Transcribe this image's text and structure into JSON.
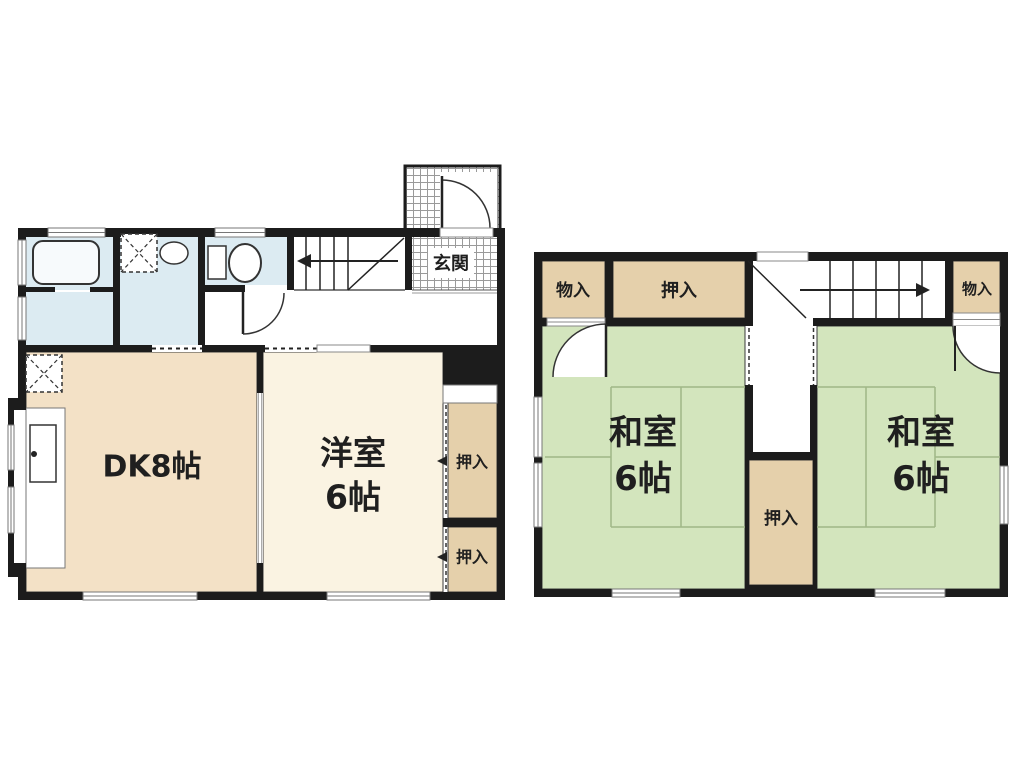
{
  "floor1": {
    "dk_label": "DK8帖",
    "western_name": "洋室",
    "western_size": "6帖",
    "genkan_label": "玄関",
    "closet_upper_label": "押入",
    "closet_lower_label": "押入"
  },
  "floor2": {
    "storage_left_label": "物入",
    "closet_top_label": "押入",
    "storage_right_label": "物入",
    "washitsu_left_name": "和室",
    "washitsu_left_size": "6帖",
    "washitsu_right_name": "和室",
    "washitsu_right_size": "6帖",
    "closet_center_label": "押入"
  },
  "colors": {
    "wall": "#1c1c1c",
    "outline": "#3a3a3a",
    "tatami_green": "#d3e5bd",
    "tatami_line": "#a0b787",
    "dk_beige": "#f3e1c6",
    "western_cream": "#faf3e2",
    "closet_tan": "#e5d0ab",
    "water_blue": "#dcebf2",
    "fixture_white": "#f7fafc",
    "hatch_line": "#9a9a9a"
  }
}
